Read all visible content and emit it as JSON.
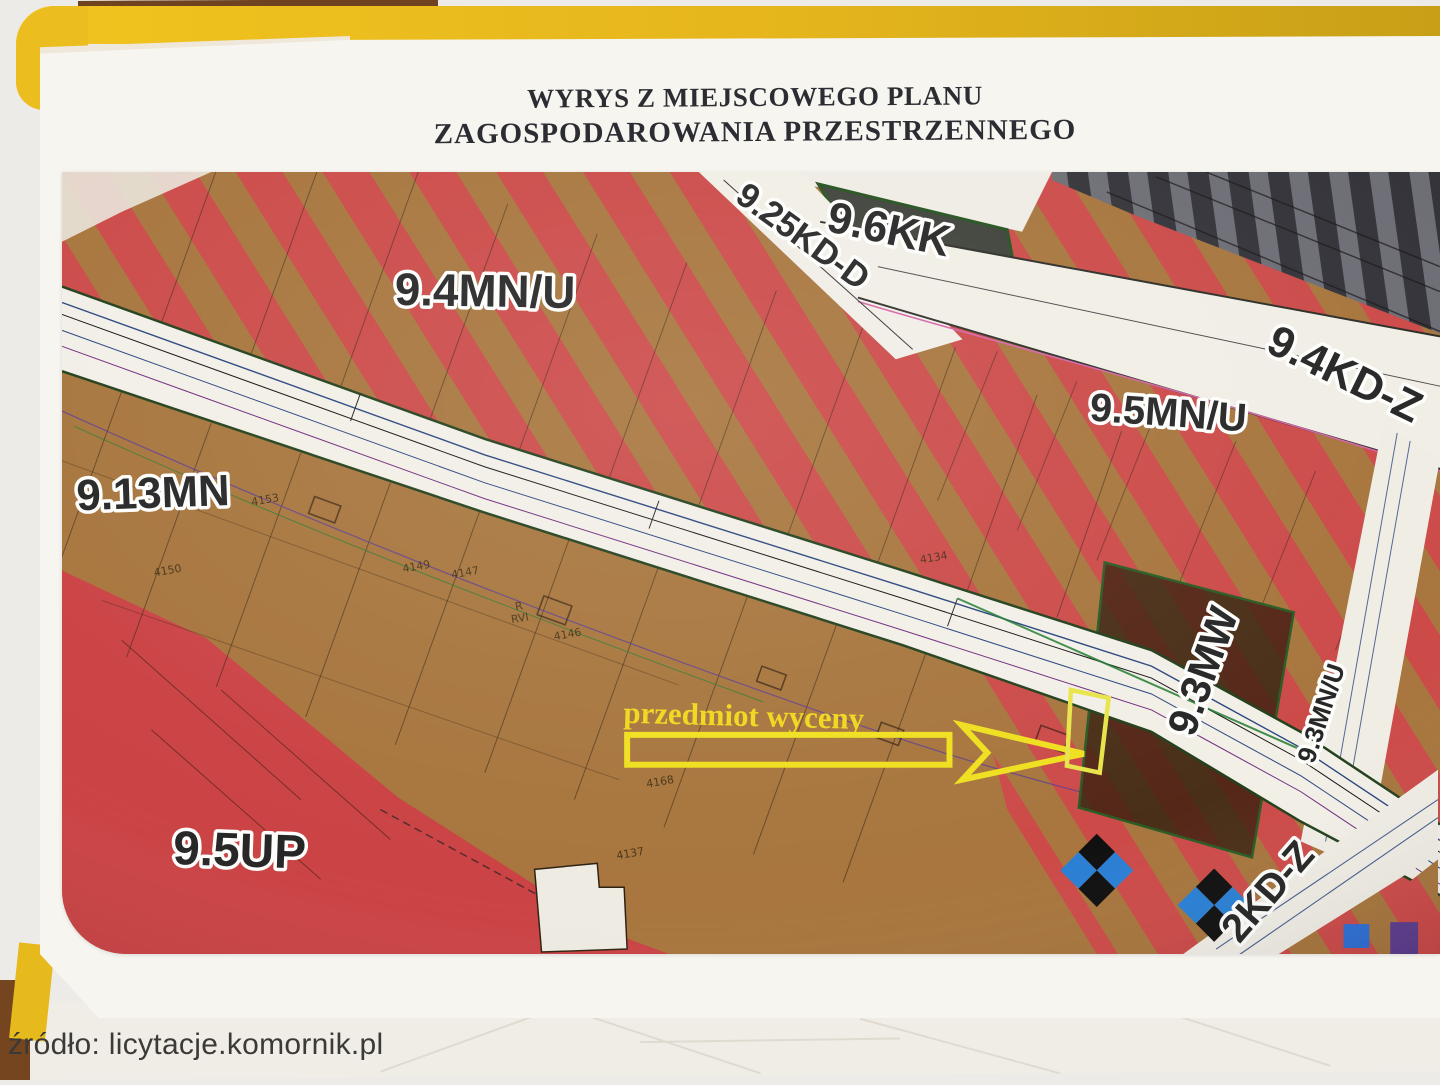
{
  "photo": {
    "title_line1": "WYRYS Z MIEJSCOWEGO PLANU",
    "title_line2": "ZAGOSPODAROWANIA PRZESTRZENNEGO",
    "source_caption": "źródło: licytacje.komornik.pl"
  },
  "map": {
    "zone_labels": {
      "z94mnu": "9.4MN/U",
      "z96kk": "9.6KK",
      "z925kdd": "9.25KD-D",
      "z94kdz": "9.4KD-Z",
      "z95mnu": "9.5MN/U",
      "z913mn": "9.13MN",
      "z93mw": "9.3MW",
      "z93mnu": "9.3MN/U",
      "z95up": "9.5UP",
      "z2kdz": "2KD-Z"
    },
    "annotation": {
      "label": "przedmiot wyceny"
    },
    "parcel_numbers": [
      "4149",
      "4147",
      "4146",
      "4153",
      "4150",
      "4134",
      "R",
      "RVI",
      "4168",
      "4137"
    ],
    "colors": {
      "parcel_brown": "#a8763e",
      "stripe_red": "#cc4b49",
      "solid_red": "#cb4345",
      "dark_brown_zone": "#4a2f18",
      "railway_dark": "#34343a",
      "railway_light": "#6e6e76",
      "road_white": "#f2efe7",
      "annotation_yellow": "#efd81d",
      "folder_yellow": "#e7ba1d"
    }
  }
}
